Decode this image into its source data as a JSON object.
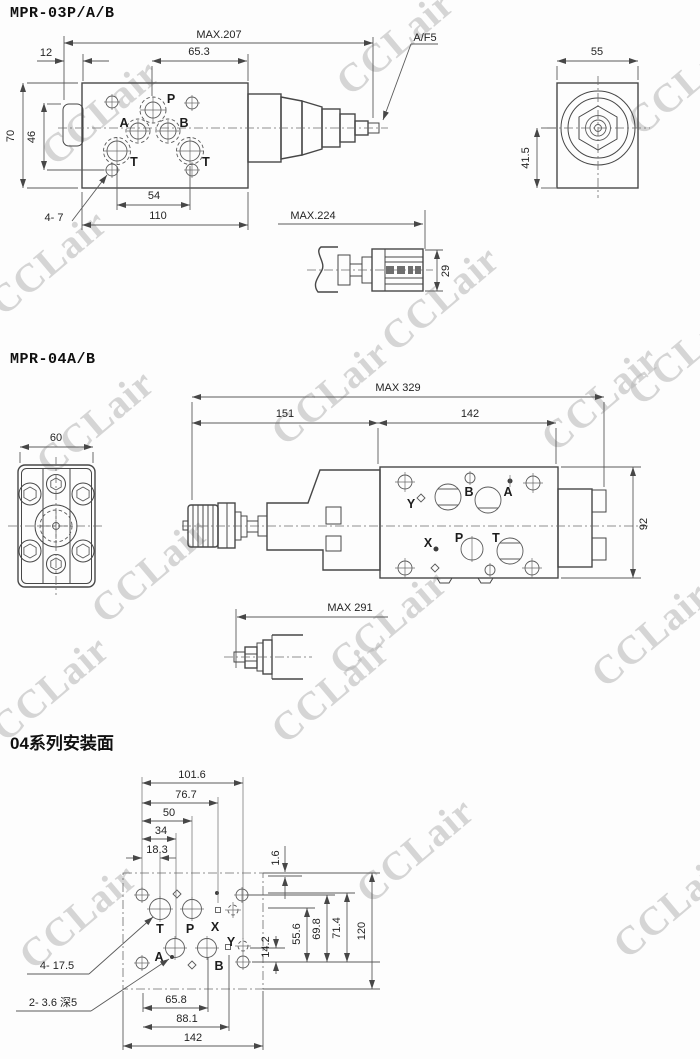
{
  "watermark": {
    "text": "CCLair"
  },
  "mpr03": {
    "title": "MPR-03P/A/B",
    "dims": {
      "max207": "MAX.207",
      "d12": "12",
      "d65_3": "65.3",
      "af5": "A/F5",
      "d70": "70",
      "d46": "46",
      "d54": "54",
      "d110": "110",
      "holes4_7": "4- 7",
      "max224": "MAX.224",
      "d29": "29",
      "d55": "55",
      "d41_5": "41.5"
    },
    "ports": {
      "p": "P",
      "a": "A",
      "b": "B",
      "t_left": "T",
      "t_right": "T"
    }
  },
  "mpr04": {
    "title": "MPR-04A/B",
    "dims": {
      "d60": "60",
      "max329": "MAX 329",
      "d151": "151",
      "d142": "142",
      "d92": "92",
      "max291": "MAX 291"
    },
    "ports": {
      "y": "Y",
      "b": "B",
      "a": "A",
      "x": "X",
      "p": "P",
      "t": "T"
    }
  },
  "mount04": {
    "title": "04系列安装面",
    "dims": {
      "d101_6": "101.6",
      "d76_7": "76.7",
      "d50": "50",
      "d34": "34",
      "d18_3": "18.3",
      "d1_6": "1.6",
      "d14_2": "14.2",
      "d55_6": "55.6",
      "d69_8": "69.8",
      "d71_4": "71.4",
      "d120": "120",
      "d65_8": "65.8",
      "d88_1": "88.1",
      "d142": "142",
      "holes4_17_5": "4- 17.5",
      "holes2_3_6": "2- 3.6 深5"
    },
    "ports": {
      "t": "T",
      "p": "P",
      "x": "X",
      "a": "A",
      "b": "B",
      "y": "Y"
    }
  }
}
